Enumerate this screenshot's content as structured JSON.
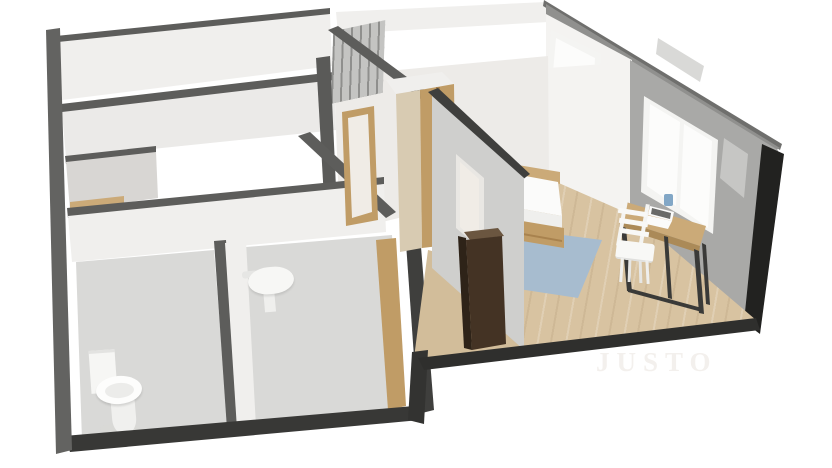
{
  "meta": {
    "render_type": "3d-floor-plan",
    "view": "dollhouse-isometric-cutaway"
  },
  "watermark": {
    "text": "JUSTO"
  },
  "colors": {
    "bg": "#ffffff",
    "wall_top": "#5d5d5b",
    "wall_top_dark": "#3f3f3d",
    "wall_white": "#f0efed",
    "wall_white_dim": "#ebeae8",
    "wall_bright": "#f4f3f1",
    "wall_gray": "#a9a9a7",
    "wall_west_face": "#cfcfcd",
    "wall_base_shadow": "#8a8a88",
    "ext_gray": "#90908e",
    "roof_edge": "#6f6f6d",
    "ext_window": "#d9d9d7",
    "backdrop": "#edebe8",
    "kitchen_gray": "#d8d6d3",
    "floor_tile": "#d9d9d7",
    "floor_wood": "#d8c3a1",
    "floor_wood_hall": "#d2bd9a",
    "rug_blue": "#a7bccf",
    "wood_light": "#cbaa78",
    "wood_mid": "#c09c66",
    "wood_dark_line": "#a8824e",
    "wardrobe_side": "#d8cbb2",
    "cabinet_dark": "#443324",
    "cabinet_top": "#6b5640",
    "cabinet_shadow": "#2e2318",
    "fixture_white": "#fbfbfa",
    "mattress_side": "#efefed",
    "door_panel": "#f0ece6",
    "door_frame_light": "#e9e7e3",
    "window_frame": "#f4f4f2",
    "window_pane": "#fcfcfb",
    "window_dim": "#c6c6c4",
    "desk_edge": "#ab8a58",
    "metal_leg": "#3a3a38",
    "laptop_screen": "#6a6a68",
    "cup_blue": "#82a7c6",
    "column_dark": "#222220",
    "column_dark2": "#333331",
    "column_gray": "#5a5a58",
    "south_wall": "#383836",
    "left_wall": "#636361",
    "baseboard": "#2f2f2d",
    "watermark": "#f3f0ed"
  },
  "scene": {
    "rooms": [
      {
        "id": "living-room"
      },
      {
        "id": "kitchen-nook"
      },
      {
        "id": "wc-bathroom"
      },
      {
        "id": "shower-room"
      },
      {
        "id": "hallway"
      },
      {
        "id": "bedroom"
      },
      {
        "id": "second-bedroom"
      }
    ],
    "furniture": [
      "bed-with-storage-drawers",
      "blue-area-rug",
      "wooden-desk",
      "white-chair",
      "laptop",
      "blue-cup",
      "dark-storage-cabinet",
      "wooden-wardrobe",
      "toilet",
      "wall-mounted-sink",
      "shelf-unit",
      "windows-with-white-curtains",
      "wooden-interior-doors"
    ]
  }
}
